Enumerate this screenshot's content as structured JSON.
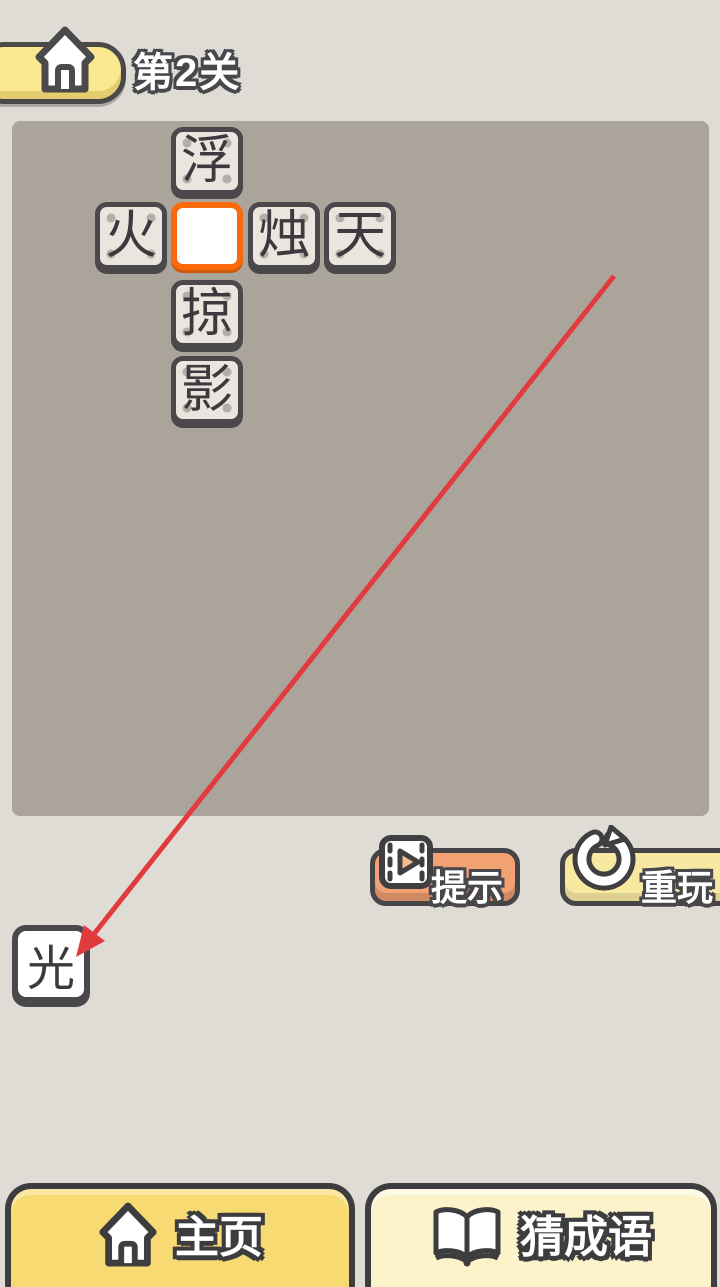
{
  "header": {
    "level_label": "第2关",
    "home_icon": "house-icon"
  },
  "board": {
    "tiles": [
      {
        "char": "浮",
        "state": "filled"
      },
      {
        "char": "火",
        "state": "filled"
      },
      {
        "char": "",
        "state": "empty-active"
      },
      {
        "char": "烛",
        "state": "filled"
      },
      {
        "char": "天",
        "state": "filled"
      },
      {
        "char": "掠",
        "state": "filled"
      },
      {
        "char": "影",
        "state": "filled"
      }
    ]
  },
  "tray": {
    "tile_char": "光"
  },
  "actions": {
    "hint_label": "提示",
    "hint_icon": "video-film-icon",
    "replay_label": "重玩",
    "replay_icon": "restart-circular-arrow-icon"
  },
  "bottom_nav": {
    "home_label": "主页",
    "home_icon": "house-icon",
    "guess_label": "猜成语",
    "guess_icon": "open-book-icon"
  },
  "annotation_arrow": {
    "from_x": 614,
    "from_y": 276,
    "to_x": 76,
    "to_y": 957,
    "color": "#e23b3e"
  },
  "colors": {
    "page_bg": "#dfdcd5",
    "board_bg": "#aba49b",
    "tile_fill": "#eae6df",
    "tile_border": "#4b484c",
    "active_tile_border": "#fa6a0d",
    "hint_button": "#f2a173",
    "replay_button": "#f7e9a2",
    "home_pill": "#f9e88f",
    "nav_home": "#f8da72",
    "nav_guess": "#fcf3cb"
  }
}
